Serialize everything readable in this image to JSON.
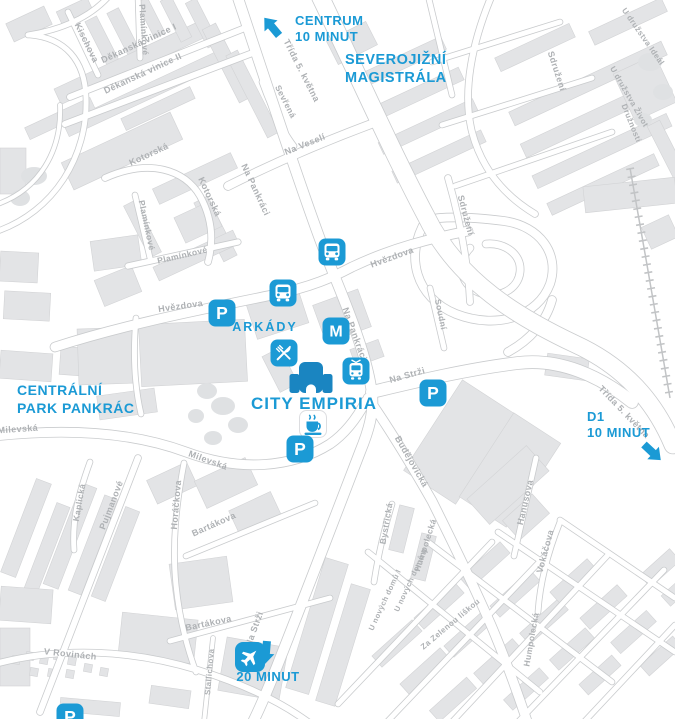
{
  "map": {
    "colors": {
      "accent": "#1b9ad5",
      "building_icon": "#1a85c1",
      "building_fill": "#e3e4e6",
      "building_stroke": "#d2d3d5",
      "road_casing": "#c9cbcd",
      "road_fill": "#ffffff",
      "street_label": "#aeb1b4",
      "railway": "#c2c4c6",
      "tree": "#dfe1e3"
    },
    "poi_labels": [
      {
        "id": "centrum",
        "lines": [
          "CENTRUM",
          "10 MINUT"
        ],
        "x": 295,
        "y": 25,
        "lh": 16,
        "s": 13,
        "anchor": "start",
        "ls": 0.5
      },
      {
        "id": "severojizni-magistrala",
        "lines": [
          "SEVEROJIŽNÍ",
          "MAGISTRÁLA"
        ],
        "x": 345,
        "y": 64,
        "lh": 18,
        "s": 14.5,
        "anchor": "start",
        "ls": 0.5
      },
      {
        "id": "arkady",
        "lines": [
          "ARKÁDY"
        ],
        "x": 265,
        "y": 331,
        "s": 12.5,
        "anchor": "middle",
        "ls": 2
      },
      {
        "id": "city-empiria",
        "lines": [
          "CITY EMPIRIA"
        ],
        "x": 314,
        "y": 409,
        "s": 17,
        "anchor": "middle",
        "ls": 1
      },
      {
        "id": "centralni-park-pankrac",
        "lines": [
          "CENTRÁLNÍ",
          "PARK PANKRÁC"
        ],
        "x": 17,
        "y": 395,
        "lh": 18,
        "s": 14,
        "anchor": "start",
        "ls": 0.5
      },
      {
        "id": "d1",
        "lines": [
          "D1",
          "10 MINUT"
        ],
        "x": 587,
        "y": 421,
        "lh": 16,
        "s": 13,
        "anchor": "start",
        "ls": 0.5
      },
      {
        "id": "airport-time",
        "lines": [
          "20 MINUT"
        ],
        "x": 268,
        "y": 681,
        "s": 13,
        "anchor": "middle",
        "ls": 0.5
      }
    ],
    "streets": [
      {
        "name": "Děkanská vinice I",
        "x": 140,
        "y": 46,
        "r": -25
      },
      {
        "name": "Děkanská vinice II",
        "x": 144,
        "y": 76,
        "r": -25
      },
      {
        "name": "Kischova",
        "x": 84,
        "y": 44,
        "r": 64
      },
      {
        "name": "Plamínkové",
        "x": 141,
        "y": 30,
        "r": 86,
        "s": 8.5
      },
      {
        "name": "Kotorská",
        "x": 150,
        "y": 157,
        "r": -25
      },
      {
        "name": "Kotorská",
        "x": 207,
        "y": 198,
        "r": 65
      },
      {
        "name": "Plamínkové",
        "x": 144,
        "y": 226,
        "r": 78,
        "s": 8.5
      },
      {
        "name": "Plamínkové",
        "x": 183,
        "y": 258,
        "r": -13,
        "s": 8.5
      },
      {
        "name": "Na Pankráci",
        "x": 253,
        "y": 191,
        "r": 65
      },
      {
        "name": "Na Pankráci",
        "x": 352,
        "y": 335,
        "r": 70
      },
      {
        "name": "Třída 5. května",
        "x": 299,
        "y": 72,
        "r": 63
      },
      {
        "name": "Sevřená",
        "x": 283,
        "y": 103,
        "r": 63,
        "s": 8.5
      },
      {
        "name": "Na Veselí",
        "x": 306,
        "y": 147,
        "r": -22
      },
      {
        "name": "Sdružení",
        "x": 463,
        "y": 216,
        "r": 75
      },
      {
        "name": "Sdružení",
        "x": 554,
        "y": 72,
        "r": 72
      },
      {
        "name": "U družstva Ideál",
        "x": 641,
        "y": 38,
        "r": 55,
        "s": 8
      },
      {
        "name": "U družstva Život",
        "x": 627,
        "y": 98,
        "r": 60,
        "s": 8
      },
      {
        "name": "Družnosti",
        "x": 629,
        "y": 124,
        "r": 68,
        "s": 8
      },
      {
        "name": "Hvězdova",
        "x": 181,
        "y": 309,
        "r": -8
      },
      {
        "name": "Hvězdova",
        "x": 393,
        "y": 260,
        "r": -20
      },
      {
        "name": "Na Strži",
        "x": 408,
        "y": 378,
        "r": -16
      },
      {
        "name": "Na Strži",
        "x": 257,
        "y": 630,
        "r": -70
      },
      {
        "name": "Budějovická",
        "x": 409,
        "y": 463,
        "r": 60
      },
      {
        "name": "Milevská",
        "x": 18,
        "y": 432,
        "r": -4
      },
      {
        "name": "Milevská",
        "x": 207,
        "y": 463,
        "r": 20
      },
      {
        "name": "Kaplická",
        "x": 82,
        "y": 503,
        "r": -80,
        "s": 8.5
      },
      {
        "name": "Pujmanové",
        "x": 114,
        "y": 506,
        "r": -69
      },
      {
        "name": "Horáčkova",
        "x": 179,
        "y": 505,
        "r": -85
      },
      {
        "name": "Bartákova",
        "x": 215,
        "y": 527,
        "r": -24
      },
      {
        "name": "Bartákova",
        "x": 209,
        "y": 626,
        "r": -12
      },
      {
        "name": "Stallichova",
        "x": 212,
        "y": 672,
        "r": -85,
        "s": 8
      },
      {
        "name": "V Rovinách",
        "x": 70,
        "y": 657,
        "r": 6
      },
      {
        "name": "Hanusova",
        "x": 528,
        "y": 503,
        "r": -77
      },
      {
        "name": "Vokáčova",
        "x": 548,
        "y": 552,
        "r": -75
      },
      {
        "name": "Humpolecká",
        "x": 428,
        "y": 546,
        "r": -72,
        "s": 8.5
      },
      {
        "name": "Humpolecká",
        "x": 534,
        "y": 640,
        "r": -80,
        "s": 8.5
      },
      {
        "name": "Za Zelenou liškou",
        "x": 452,
        "y": 626,
        "r": -40,
        "s": 8
      },
      {
        "name": "U nových domů I",
        "x": 387,
        "y": 601,
        "r": -65,
        "s": 7.5
      },
      {
        "name": "U nových domů II",
        "x": 413,
        "y": 581,
        "r": -65,
        "s": 7.5
      },
      {
        "name": "Bystřická",
        "x": 389,
        "y": 524,
        "r": -80,
        "s": 8.5
      },
      {
        "name": "Soudní",
        "x": 438,
        "y": 315,
        "r": 78,
        "s": 8.5
      },
      {
        "name": "Třída 5. května",
        "x": 622,
        "y": 414,
        "r": 46
      }
    ],
    "icons": [
      {
        "type": "parking",
        "x": 222,
        "y": 313
      },
      {
        "type": "bus",
        "x": 283,
        "y": 293
      },
      {
        "type": "bus",
        "x": 332,
        "y": 252
      },
      {
        "type": "metro",
        "x": 336,
        "y": 331
      },
      {
        "type": "restaurant",
        "x": 284,
        "y": 353
      },
      {
        "type": "tram",
        "x": 356,
        "y": 371
      },
      {
        "type": "building",
        "x": 311,
        "y": 381,
        "size": 46
      },
      {
        "type": "coffee",
        "x": 313,
        "y": 424
      },
      {
        "type": "parking",
        "x": 300,
        "y": 449
      },
      {
        "type": "parking",
        "x": 433,
        "y": 393
      },
      {
        "type": "airplane",
        "x": 250,
        "y": 657,
        "size": 30
      },
      {
        "type": "parking",
        "x": 70,
        "y": 717
      }
    ],
    "arrows": [
      {
        "id": "centrum-arrow",
        "x": 272,
        "y": 27,
        "r": -40
      },
      {
        "id": "d1-arrow",
        "x": 652,
        "y": 452,
        "r": 133
      },
      {
        "id": "south-arrow",
        "x": 266,
        "y": 652,
        "r": 185
      }
    ]
  }
}
